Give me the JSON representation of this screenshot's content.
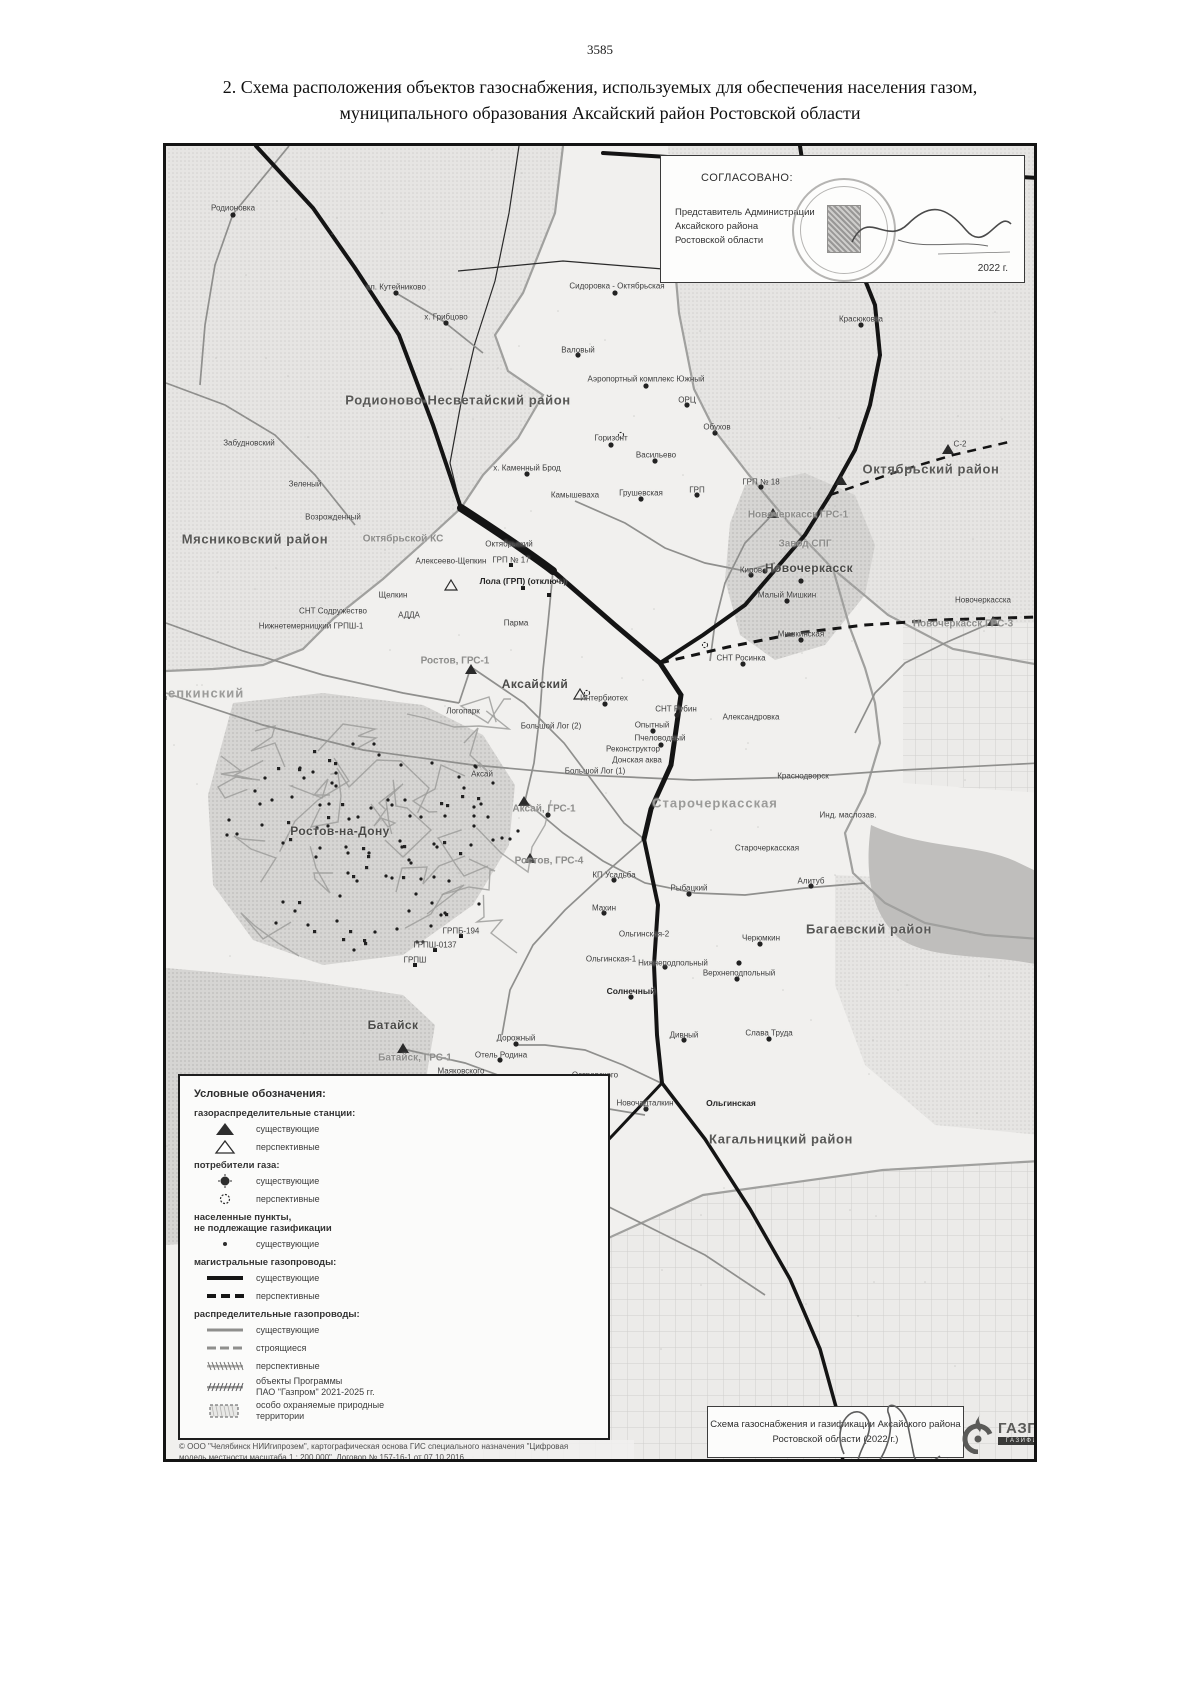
{
  "page": {
    "number": "3585",
    "title_line1": "2. Схема расположения объектов газоснабжения, используемых для обеспечения населения газом,",
    "title_line2": "муниципального образования Аксайский район Ростовской области"
  },
  "approval": {
    "heading": "СОГЛАСОВАНО:",
    "line1": "Представитель Администрации",
    "line2": "Аксайского района",
    "line3": "Ростовской области",
    "signature_name": "Морозов",
    "year": "2022 г."
  },
  "map_title_box": {
    "line1": "Схема газоснабжения и газификации Аксайского района",
    "line2": "Ростовской области (2022 г.)"
  },
  "logo": {
    "name": "ГАЗПРОМ",
    "subtitle": "ГАЗИФИКАЦИЯ"
  },
  "copyright": {
    "line1": "© ООО \"Челябинск НИИгипрозем\", картографическая основа ГИС специального назначения \"Цифровая",
    "line2": "модель местности масштаба 1 : 200 000\", Договор № 157-16-1 от 07.10.2016"
  },
  "legend": {
    "title": "Условные обозначения:",
    "groups": [
      {
        "heading": "газораспределительные станции:",
        "items": [
          {
            "sym": "tri",
            "label": "существующие"
          },
          {
            "sym": "tri-o",
            "label": "перспективные"
          }
        ]
      },
      {
        "heading": "потребители газа:",
        "items": [
          {
            "sym": "cir",
            "label": "существующие"
          },
          {
            "sym": "cir-o",
            "label": "перспективные"
          }
        ]
      },
      {
        "heading": "населенные пункты,\nне подлежащие газификации",
        "items": [
          {
            "sym": "dot",
            "label": "существующие"
          }
        ]
      },
      {
        "heading": "магистральные газопроводы:",
        "items": [
          {
            "sym": "line-black",
            "label": "существующие"
          },
          {
            "sym": "line-black-dash",
            "label": "перспективные"
          }
        ]
      },
      {
        "heading": "распределительные газопроводы:",
        "items": [
          {
            "sym": "line-gray",
            "label": "существующие"
          },
          {
            "sym": "line-gray-dash",
            "label": "строящиеся"
          },
          {
            "sym": "line-hatch",
            "label": "перспективные"
          },
          {
            "sym": "line-hatch2",
            "label": "объекты Программы\nПАО \"Газпром\" 2021-2025 гг."
          },
          {
            "sym": "rect-dash",
            "label": "особо охраняемые природные\nтерритории"
          }
        ]
      }
    ]
  },
  "map": {
    "labels": [
      {
        "t": "Родионовка",
        "x": 230,
        "y": 205,
        "c": "s"
      },
      {
        "t": "сл. Кутейниково",
        "x": 393,
        "y": 284,
        "c": "s"
      },
      {
        "t": "х. Грибцово",
        "x": 443,
        "y": 314,
        "c": "s"
      },
      {
        "t": "Сидоровка - Октябрьская",
        "x": 614,
        "y": 283,
        "c": "s"
      },
      {
        "t": "Красюковка",
        "x": 858,
        "y": 316,
        "c": "s"
      },
      {
        "t": "Валовый",
        "x": 575,
        "y": 347,
        "c": "s"
      },
      {
        "t": "Аэропортный комплекс Южный",
        "x": 643,
        "y": 376,
        "c": "s"
      },
      {
        "t": "ОРЦ",
        "x": 684,
        "y": 397,
        "c": "s"
      },
      {
        "t": "Обухов",
        "x": 714,
        "y": 424,
        "c": "s"
      },
      {
        "t": "Горизонт",
        "x": 608,
        "y": 435,
        "c": "s"
      },
      {
        "t": "Васильево",
        "x": 653,
        "y": 452,
        "c": "s"
      },
      {
        "t": "С-2",
        "x": 957,
        "y": 441,
        "c": "s"
      },
      {
        "t": "Октябрьский район",
        "x": 928,
        "y": 466,
        "c": "r"
      },
      {
        "t": "х. Каменный Брод",
        "x": 524,
        "y": 465,
        "c": "s"
      },
      {
        "t": "Забудновский",
        "x": 246,
        "y": 440,
        "c": "s"
      },
      {
        "t": "Зеленый",
        "x": 302,
        "y": 481,
        "c": "s"
      },
      {
        "t": "Возрожденный",
        "x": 330,
        "y": 514,
        "c": "s"
      },
      {
        "t": "Камышеваха",
        "x": 572,
        "y": 492,
        "c": "s"
      },
      {
        "t": "Грушевская",
        "x": 638,
        "y": 490,
        "c": "s"
      },
      {
        "t": "ГРП",
        "x": 694,
        "y": 487,
        "c": "s"
      },
      {
        "t": "ГРП № 18",
        "x": 758,
        "y": 479,
        "c": "s"
      },
      {
        "t": "Мясниковский район",
        "x": 252,
        "y": 536,
        "c": "r"
      },
      {
        "t": "Октябрьской КС",
        "x": 400,
        "y": 536,
        "c": "g"
      },
      {
        "t": "Октябрьский",
        "x": 506,
        "y": 541,
        "c": "s"
      },
      {
        "t": "ГРП № 17",
        "x": 508,
        "y": 557,
        "c": "s"
      },
      {
        "t": "Алексеево-Щепкин",
        "x": 448,
        "y": 558,
        "c": "s"
      },
      {
        "t": "Новочеркасск ГРС-1",
        "x": 795,
        "y": 512,
        "c": "g"
      },
      {
        "t": "Завод СПГ",
        "x": 802,
        "y": 541,
        "c": "g"
      },
      {
        "t": "Киров",
        "x": 748,
        "y": 567,
        "c": "s"
      },
      {
        "t": "Новочеркасск",
        "x": 806,
        "y": 565,
        "c": "c"
      },
      {
        "t": "Лола (ГРП) (отключ.)",
        "x": 520,
        "y": 578,
        "c": "b"
      },
      {
        "t": "Малый Мишкин",
        "x": 784,
        "y": 592,
        "c": "s"
      },
      {
        "t": "Новочеркасска",
        "x": 980,
        "y": 597,
        "c": "s"
      },
      {
        "t": "Щелкин",
        "x": 390,
        "y": 592,
        "c": "s"
      },
      {
        "t": "СНТ Содружество",
        "x": 330,
        "y": 608,
        "c": "s"
      },
      {
        "t": "АДДА",
        "x": 406,
        "y": 612,
        "c": "s"
      },
      {
        "t": "Нижнетемерницкий ГРПШ-1",
        "x": 308,
        "y": 623,
        "c": "s"
      },
      {
        "t": "Парма",
        "x": 513,
        "y": 620,
        "c": "s"
      },
      {
        "t": "Новочеркасск ГРС-3",
        "x": 960,
        "y": 621,
        "c": "g"
      },
      {
        "t": "Мишкинская",
        "x": 798,
        "y": 631,
        "c": "s"
      },
      {
        "t": "СНТ Росинка",
        "x": 738,
        "y": 655,
        "c": "s"
      },
      {
        "t": "Ростов, ГРС-1",
        "x": 452,
        "y": 658,
        "c": "g"
      },
      {
        "t": "Щепкинский",
        "x": 196,
        "y": 690,
        "c": "g2"
      },
      {
        "t": "Аксайский",
        "x": 532,
        "y": 681,
        "c": "c"
      },
      {
        "t": "Интербиотех",
        "x": 601,
        "y": 695,
        "c": "s"
      },
      {
        "t": "СНТ Рубин",
        "x": 673,
        "y": 706,
        "c": "s"
      },
      {
        "t": "Александровка",
        "x": 748,
        "y": 714,
        "c": "s"
      },
      {
        "t": "Логопарк",
        "x": 460,
        "y": 708,
        "c": "s"
      },
      {
        "t": "Опытный",
        "x": 649,
        "y": 722,
        "c": "s"
      },
      {
        "t": "Большой Лог (2)",
        "x": 548,
        "y": 723,
        "c": "s"
      },
      {
        "t": "Пчеловодный",
        "x": 657,
        "y": 735,
        "c": "s"
      },
      {
        "t": "Реконструктор",
        "x": 630,
        "y": 746,
        "c": "s"
      },
      {
        "t": "Донская аква",
        "x": 634,
        "y": 757,
        "c": "s"
      },
      {
        "t": "Большой Лог (1)",
        "x": 592,
        "y": 768,
        "c": "s"
      },
      {
        "t": "Аксай",
        "x": 479,
        "y": 771,
        "c": "s"
      },
      {
        "t": "Краснодворск",
        "x": 800,
        "y": 773,
        "c": "s"
      },
      {
        "t": "Ростов-на-Дону",
        "x": 337,
        "y": 828,
        "c": "c"
      },
      {
        "t": "Аксай, ГРС-1",
        "x": 541,
        "y": 806,
        "c": "g"
      },
      {
        "t": "Старочеркасская",
        "x": 712,
        "y": 800,
        "c": "g2"
      },
      {
        "t": "Инд. маслозав.",
        "x": 845,
        "y": 812,
        "c": "s"
      },
      {
        "t": "Старочеркасская",
        "x": 764,
        "y": 845,
        "c": "s"
      },
      {
        "t": "Ростов, ГРС-4",
        "x": 546,
        "y": 858,
        "c": "g"
      },
      {
        "t": "КП Усадьба",
        "x": 611,
        "y": 872,
        "c": "s"
      },
      {
        "t": "Рыбацкий",
        "x": 686,
        "y": 885,
        "c": "s"
      },
      {
        "t": "Алитуб",
        "x": 808,
        "y": 878,
        "c": "s"
      },
      {
        "t": "Махин",
        "x": 601,
        "y": 905,
        "c": "s"
      },
      {
        "t": "Багаевский район",
        "x": 866,
        "y": 926,
        "c": "r"
      },
      {
        "t": "ГРПБ-194",
        "x": 458,
        "y": 928,
        "c": "s"
      },
      {
        "t": "ГРПШ-0137",
        "x": 432,
        "y": 942,
        "c": "s"
      },
      {
        "t": "ГРПШ",
        "x": 412,
        "y": 957,
        "c": "s"
      },
      {
        "t": "Ольгинская-2",
        "x": 641,
        "y": 931,
        "c": "s"
      },
      {
        "t": "Черюмкин",
        "x": 758,
        "y": 935,
        "c": "s"
      },
      {
        "t": "Ольгинская-1",
        "x": 608,
        "y": 956,
        "c": "s"
      },
      {
        "t": "Нижнеподпольный",
        "x": 670,
        "y": 960,
        "c": "s"
      },
      {
        "t": "Верхнеподпольный",
        "x": 736,
        "y": 970,
        "c": "s"
      },
      {
        "t": "Солнечный",
        "x": 628,
        "y": 988,
        "c": "b"
      },
      {
        "t": "Батайск",
        "x": 390,
        "y": 1022,
        "c": "c"
      },
      {
        "t": "Дорожный",
        "x": 513,
        "y": 1035,
        "c": "s"
      },
      {
        "t": "Дивный",
        "x": 681,
        "y": 1032,
        "c": "s"
      },
      {
        "t": "Слава Труда",
        "x": 766,
        "y": 1030,
        "c": "s"
      },
      {
        "t": "Батайск, ГРС-1",
        "x": 412,
        "y": 1055,
        "c": "g"
      },
      {
        "t": "Отель Родина",
        "x": 498,
        "y": 1052,
        "c": "s"
      },
      {
        "t": "Маяковского",
        "x": 458,
        "y": 1068,
        "c": "s"
      },
      {
        "t": "Островского",
        "x": 592,
        "y": 1072,
        "c": "s"
      },
      {
        "t": "Ленина",
        "x": 528,
        "y": 1092,
        "c": "s"
      },
      {
        "t": "Новочадталкин",
        "x": 642,
        "y": 1100,
        "c": "s"
      },
      {
        "t": "Ольгинская",
        "x": 728,
        "y": 1100,
        "c": "b"
      },
      {
        "t": "Кагальницкий район",
        "x": 778,
        "y": 1136,
        "c": "r"
      },
      {
        "t": "Алтей",
        "x": 390,
        "y": 1128,
        "c": "s"
      },
      {
        "t": "Атлантис Пак",
        "x": 530,
        "y": 1127,
        "c": "s"
      },
      {
        "t": "Юнипак Ростов",
        "x": 470,
        "y": 1140,
        "c": "s"
      },
      {
        "t": "Истокино",
        "x": 524,
        "y": 1155,
        "c": "s"
      },
      {
        "t": "Юнго-Батайская пром. зона",
        "x": 470,
        "y": 1168,
        "c": "s"
      },
      {
        "t": "х. Мирный Батай",
        "x": 505,
        "y": 1207,
        "c": "s"
      },
      {
        "t": "Родионово-Несветайский район",
        "x": 455,
        "y": 397,
        "c": "r"
      }
    ],
    "grs_existing": [
      [
        468,
        667
      ],
      [
        521,
        799
      ],
      [
        527,
        856
      ],
      [
        400,
        1046
      ],
      [
        770,
        511
      ],
      [
        990,
        619
      ],
      [
        945,
        447
      ],
      [
        838,
        478
      ]
    ],
    "grs_planned": [
      [
        448,
        583
      ],
      [
        577,
        692
      ]
    ],
    "consumers": [
      [
        684,
        402
      ],
      [
        712,
        430
      ],
      [
        608,
        442
      ],
      [
        652,
        458
      ],
      [
        748,
        572
      ],
      [
        784,
        598
      ],
      [
        740,
        661
      ],
      [
        674,
        712
      ],
      [
        650,
        728
      ],
      [
        658,
        742
      ],
      [
        602,
        701
      ],
      [
        545,
        812
      ],
      [
        686,
        891
      ],
      [
        757,
        941
      ],
      [
        734,
        976
      ],
      [
        628,
        994
      ],
      [
        681,
        1037
      ],
      [
        766,
        1036
      ],
      [
        513,
        1041
      ],
      [
        497,
        1057
      ],
      [
        458,
        1074
      ],
      [
        592,
        1078
      ],
      [
        528,
        1098
      ],
      [
        643,
        1106
      ],
      [
        471,
        1146
      ],
      [
        531,
        1132
      ],
      [
        524,
        1160
      ],
      [
        503,
        1212
      ],
      [
        575,
        352
      ],
      [
        643,
        383
      ],
      [
        858,
        322
      ],
      [
        612,
        290
      ],
      [
        393,
        290
      ],
      [
        230,
        212
      ],
      [
        443,
        320
      ],
      [
        524,
        471
      ],
      [
        638,
        496
      ],
      [
        694,
        492
      ],
      [
        758,
        484
      ],
      [
        798,
        637
      ],
      [
        808,
        883
      ],
      [
        611,
        877
      ],
      [
        601,
        910
      ],
      [
        798,
        578
      ],
      [
        762,
        568
      ],
      [
        736,
        960
      ],
      [
        662,
        964
      ]
    ],
    "consumers_planned": [
      [
        618,
        432
      ],
      [
        462,
        1080
      ],
      [
        702,
        642
      ],
      [
        584,
        690
      ]
    ],
    "grp_squares": [
      [
        458,
        933
      ],
      [
        432,
        947
      ],
      [
        412,
        962
      ],
      [
        508,
        562
      ],
      [
        520,
        585
      ],
      [
        546,
        592
      ]
    ]
  },
  "colors": {
    "pipeline_main": "#141414",
    "pipeline_distribution": "#8f8f8d",
    "district_shade": "#d6d5d3",
    "river": "#bfbebc"
  }
}
